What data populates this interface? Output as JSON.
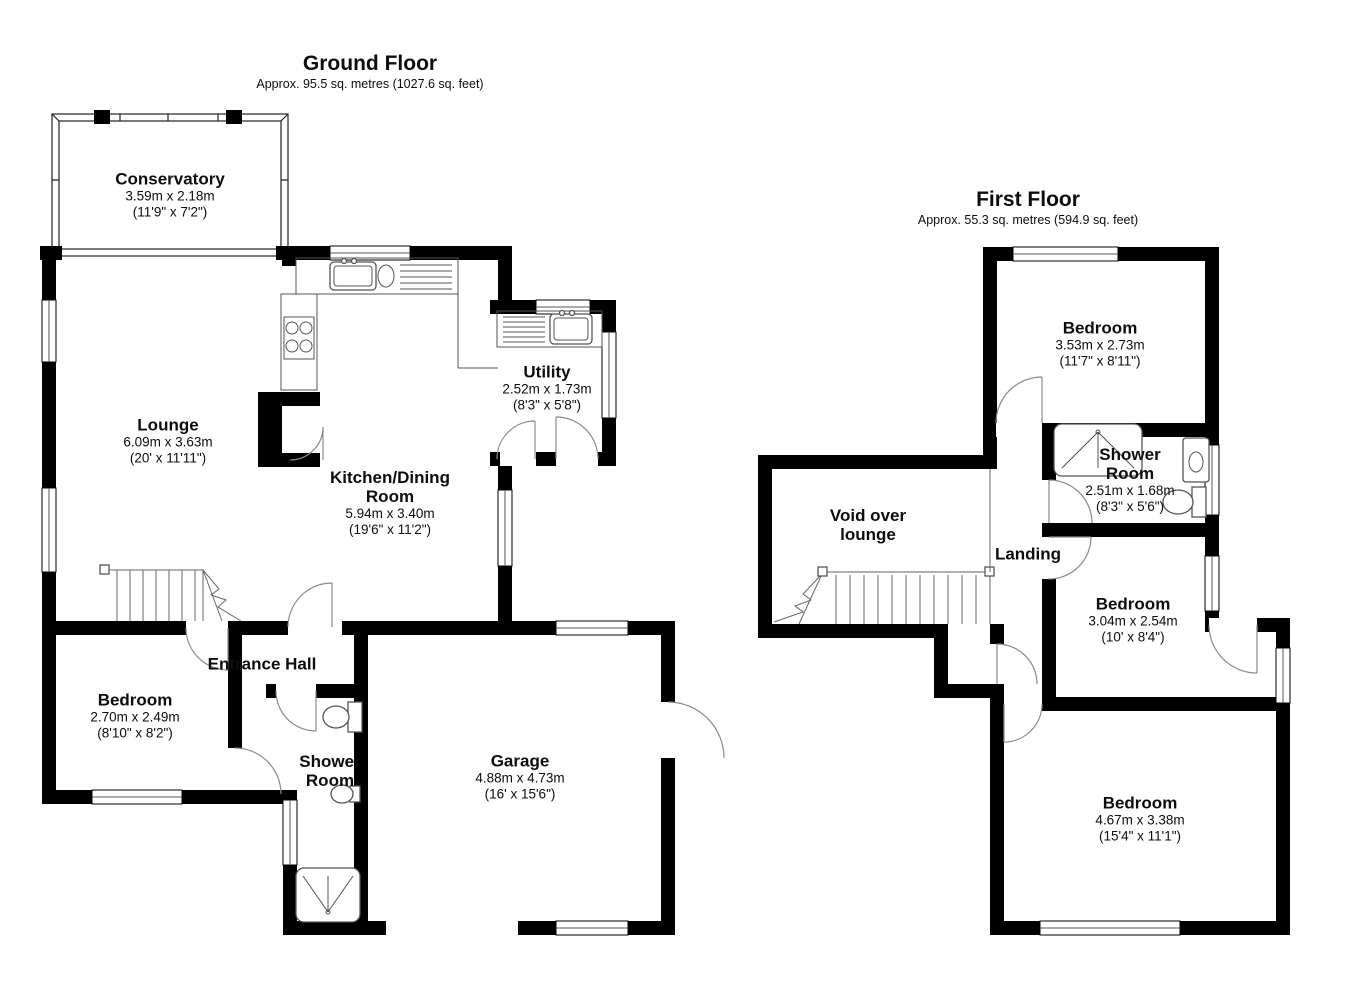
{
  "ground_floor": {
    "title": "Ground Floor",
    "subtitle": "Approx. 95.5 sq. metres (1027.6 sq. feet)",
    "rooms": {
      "conservatory": {
        "name": "Conservatory",
        "metric": "3.59m x 2.18m",
        "imperial": "(11'9\" x 7'2\")"
      },
      "lounge": {
        "name": "Lounge",
        "metric": "6.09m x 3.63m",
        "imperial": "(20' x 11'11\")"
      },
      "kitchen_dining": {
        "name": "Kitchen/Dining Room",
        "metric": "5.94m x 3.40m",
        "imperial": "(19'6\" x 11'2\")"
      },
      "utility": {
        "name": "Utility",
        "metric": "2.52m x 1.73m",
        "imperial": "(8'3\" x 5'8\")"
      },
      "entrance_hall": {
        "name": "Entrance Hall"
      },
      "bedroom": {
        "name": "Bedroom",
        "metric": "2.70m x 2.49m",
        "imperial": "(8'10\" x 8'2\")"
      },
      "shower_room": {
        "name": "Shower Room"
      },
      "garage": {
        "name": "Garage",
        "metric": "4.88m x 4.73m",
        "imperial": "(16' x 15'6\")"
      }
    }
  },
  "first_floor": {
    "title": "First Floor",
    "subtitle": "Approx. 55.3 sq. metres (594.9 sq. feet)",
    "rooms": {
      "bedroom_front": {
        "name": "Bedroom",
        "metric": "3.53m x 2.73m",
        "imperial": "(11'7\" x 8'11\")"
      },
      "shower_room": {
        "name": "Shower Room",
        "metric": "2.51m x 1.68m",
        "imperial": "(8'3\" x 5'6\")"
      },
      "void": {
        "name": "Void over lounge"
      },
      "landing": {
        "name": "Landing"
      },
      "bedroom_middle": {
        "name": "Bedroom",
        "metric": "3.04m x 2.54m",
        "imperial": "(10' x 8'4\")"
      },
      "bedroom_rear": {
        "name": "Bedroom",
        "metric": "4.67m x 3.38m",
        "imperial": "(15'4\" x 11'1\")"
      }
    }
  },
  "colors": {
    "wall": "#000000",
    "door_arc": "#8a8a8a",
    "text": "#0d0d0d",
    "background": "#ffffff"
  }
}
